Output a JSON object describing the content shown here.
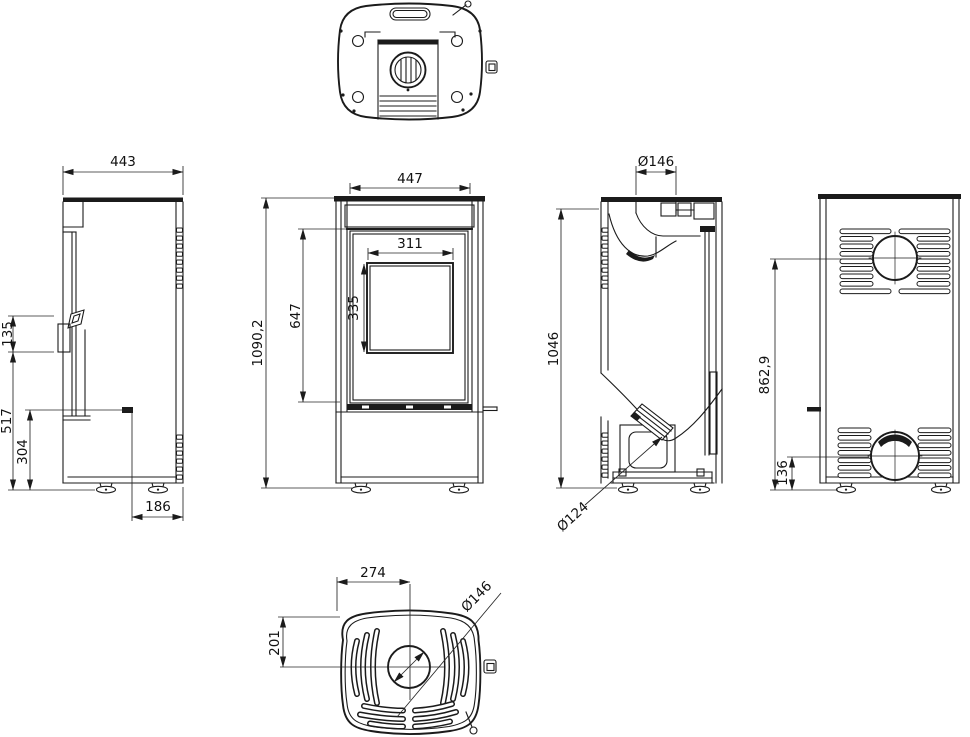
{
  "drawing": {
    "ink_color": "#1b1b1b",
    "background_color": "#ffffff",
    "dimensions": {
      "side": {
        "depth": "443",
        "handle_height": "135",
        "front_height": "517",
        "base_height": "304",
        "base_depth": "186"
      },
      "front": {
        "width": "447",
        "glass_width": "311",
        "glass_height": "335",
        "door_height": "647",
        "total_height": "1090,2"
      },
      "section": {
        "flue_diameter": "Ø146",
        "height": "1046",
        "duct_diameter": "Ø124"
      },
      "rear": {
        "flue_center_height": "862,9",
        "inlet_center_height": "136"
      },
      "top_plate": {
        "center_offset_x": "274",
        "center_offset_y": "201",
        "flue_diameter": "Ø146"
      }
    }
  }
}
